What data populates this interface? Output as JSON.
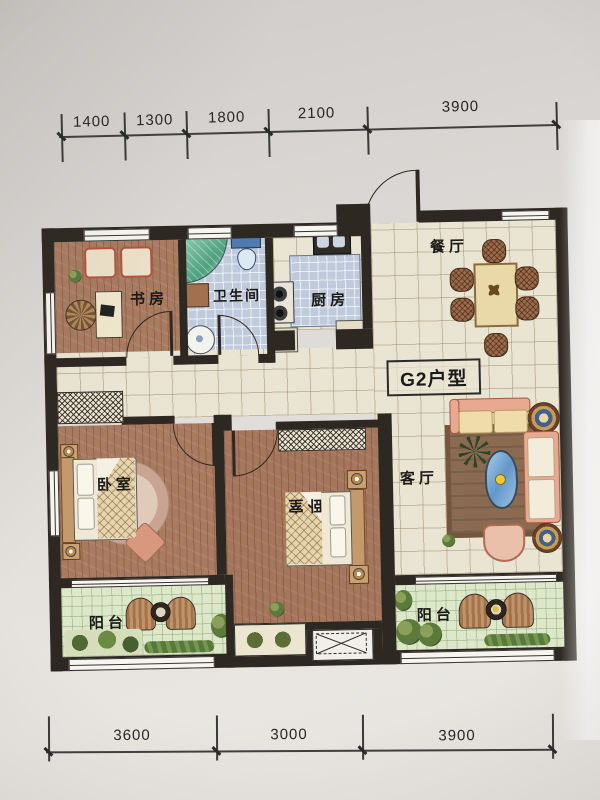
{
  "photo": {
    "paper_top": "#cdc9c6",
    "paper_bottom": "#e7e4e0"
  },
  "dimensions": {
    "top": [
      "1400",
      "1300",
      "1800",
      "2100",
      "3900"
    ],
    "bottom": [
      "3600",
      "3000",
      "3900"
    ]
  },
  "plan": {
    "unit_label": "G2户型",
    "rooms": {
      "study": "书房",
      "bathroom": "卫生间",
      "kitchen": "厨房",
      "dining": "餐厅",
      "living": "客厅",
      "bedroom_left": "卧室",
      "bedroom_middle": "卧室",
      "balcony_left": "阳台",
      "balcony_right": "阳台"
    },
    "colors": {
      "wall": "#2e2822",
      "tile_cream": "#e9e3d1",
      "tile_blue": "#becbdc",
      "tile_green": "#dde8ca",
      "wood": "#a87b61",
      "rug": "#8a6b52",
      "sofa": "#e7a98f",
      "shower_glass": "#79c2a2"
    }
  }
}
